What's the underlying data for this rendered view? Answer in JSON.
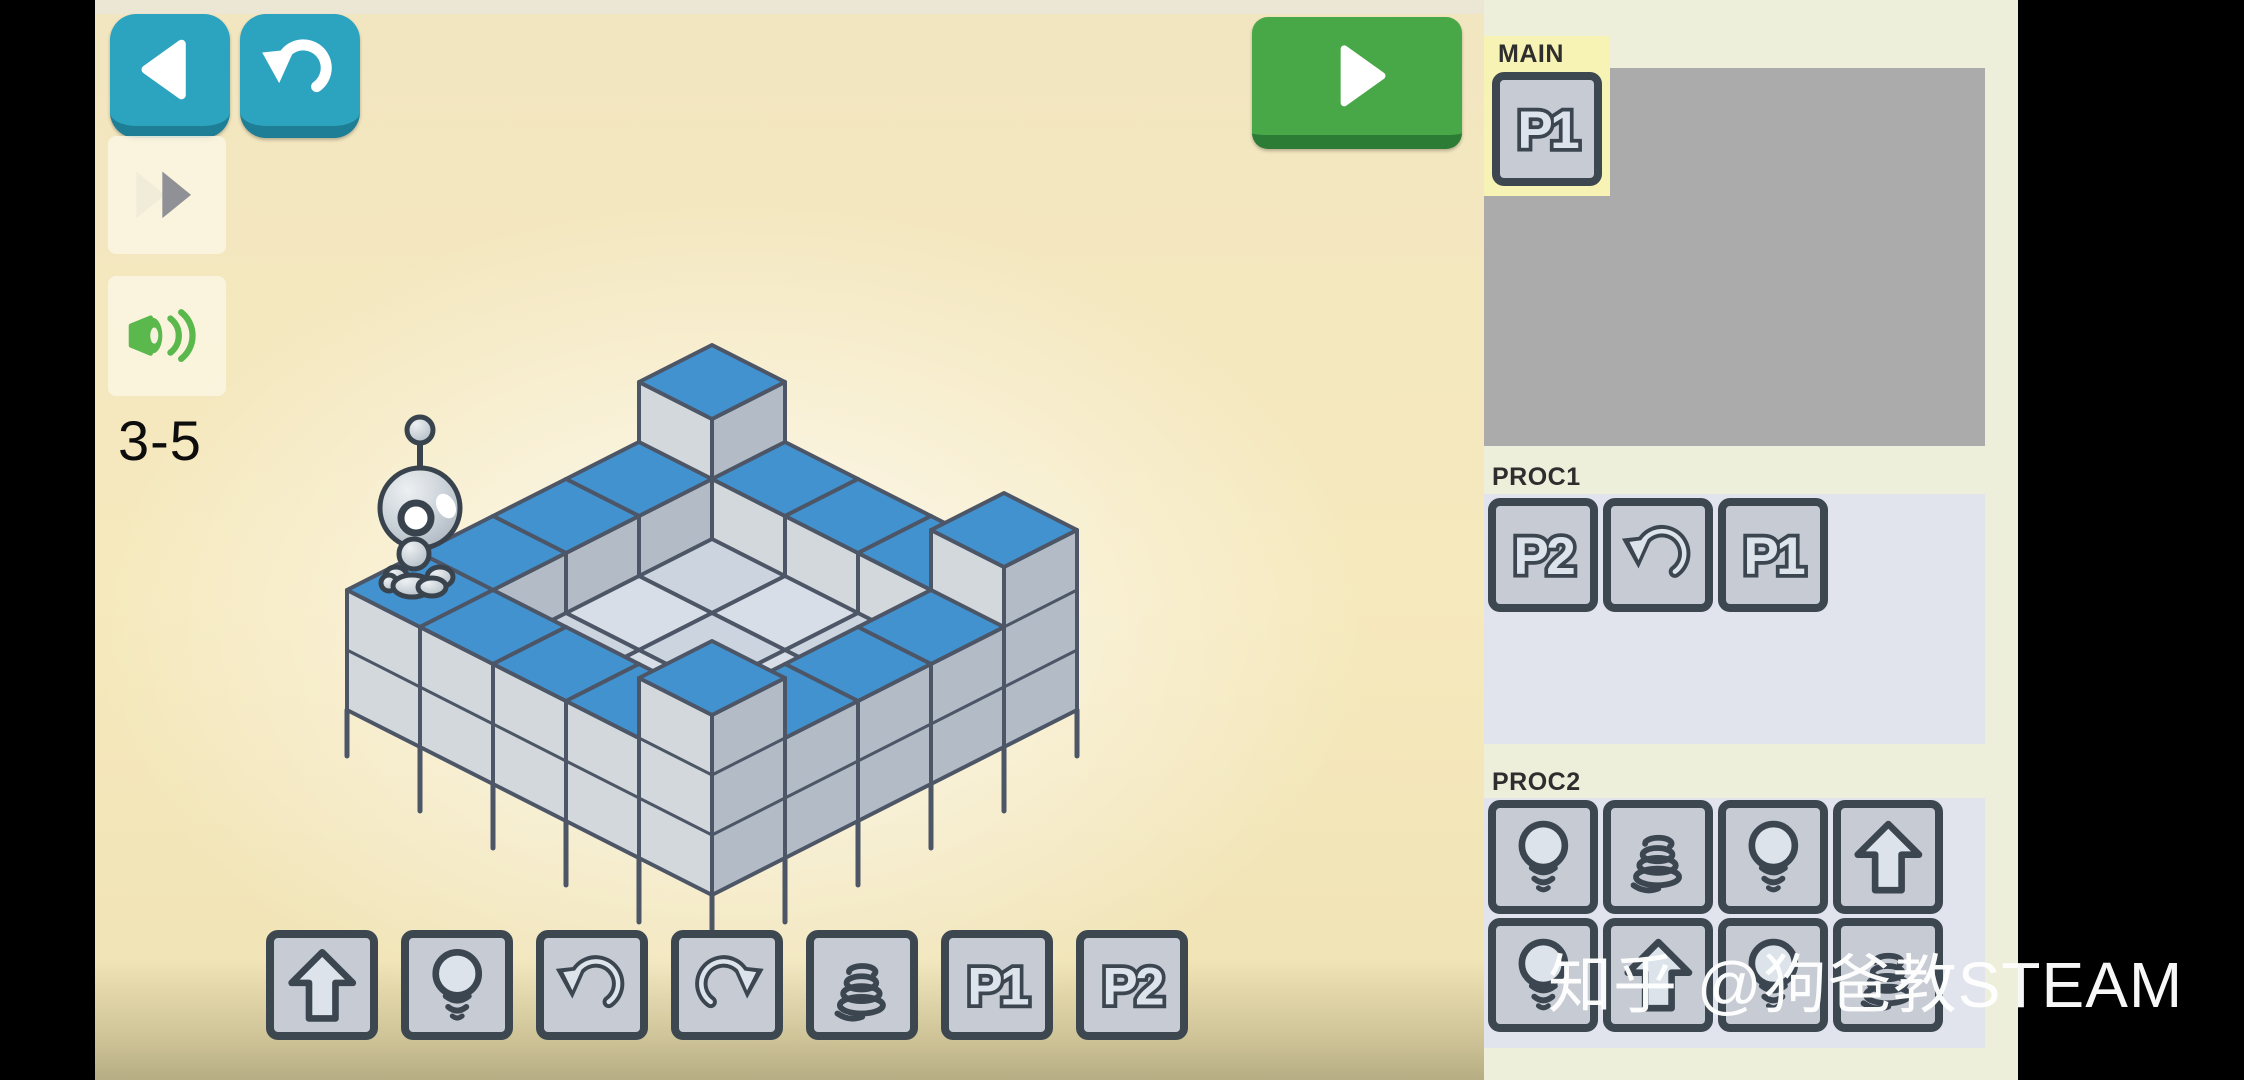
{
  "hud": {
    "level_label": "3-5",
    "buttons": {
      "back": {
        "icon": "back-arrow"
      },
      "undo": {
        "icon": "undo-arrow"
      },
      "fast_forward": {
        "icon": "fast-forward"
      },
      "sound": {
        "icon": "sound-on"
      },
      "play": {
        "icon": "play"
      }
    }
  },
  "watermark": {
    "text": "知乎 @狗爸教STEAM",
    "color": "#ffffff"
  },
  "palette": {
    "commands": [
      "walk",
      "light",
      "turn-left",
      "turn-right",
      "jump",
      "p1",
      "p2"
    ]
  },
  "panel": {
    "sections": [
      {
        "id": "main",
        "label": "MAIN",
        "active": true,
        "slots": [
          "p1"
        ]
      },
      {
        "id": "proc1",
        "label": "PROC1",
        "active": false,
        "slots": [
          "p2",
          "turn-left",
          "p1"
        ]
      },
      {
        "id": "proc2",
        "label": "PROC2",
        "active": false,
        "slots": [
          "light",
          "jump",
          "light",
          "walk",
          "light",
          "walk",
          "light",
          "jump"
        ]
      }
    ]
  },
  "icons": {
    "p1": {
      "label": "P1"
    },
    "p2": {
      "label": "P2"
    }
  },
  "level": {
    "grid": [
      [
        3,
        2,
        2,
        2,
        2
      ],
      [
        2,
        1,
        1,
        1,
        2
      ],
      [
        2,
        1,
        1,
        1,
        2
      ],
      [
        2,
        1,
        1,
        1,
        2
      ],
      [
        3,
        2,
        2,
        2,
        3
      ]
    ],
    "tops": [
      [
        "B",
        "B",
        "B",
        "B",
        "B"
      ],
      [
        "B",
        "G",
        "G",
        "G",
        "B"
      ],
      [
        "B",
        "G",
        "G",
        "G",
        "B"
      ],
      [
        "B",
        "G",
        "G",
        "G",
        "B"
      ],
      [
        "B",
        "B",
        "B",
        "B",
        "B"
      ]
    ],
    "robot": {
      "u": 0,
      "v": 4
    },
    "colors": {
      "top_blue": "#4292d0",
      "top_gray": "#ccd4e0",
      "top_gray_alt": "#d8dee8",
      "face_left": "#d3d8dc",
      "face_right": "#b3bcc6",
      "stroke": "#4d5666"
    }
  },
  "theme": {
    "teal": "#2ca3bf",
    "teal_dark": "#1e7e95",
    "green": "#48a848",
    "green_dark": "#2d7c36",
    "panel_bg": "#edefdb",
    "box_gray": "#ababab",
    "box_light": "#e2e4ed",
    "highlight_yellow": "#f7f3b5",
    "tile_fill": "#c6cbd4",
    "tile_border": "#3d4750",
    "icon_dark": "#3c4650",
    "icon_light": "#dde3ea",
    "bg_cream": "#f5e8bd",
    "sound_green": "#5bb84c"
  }
}
